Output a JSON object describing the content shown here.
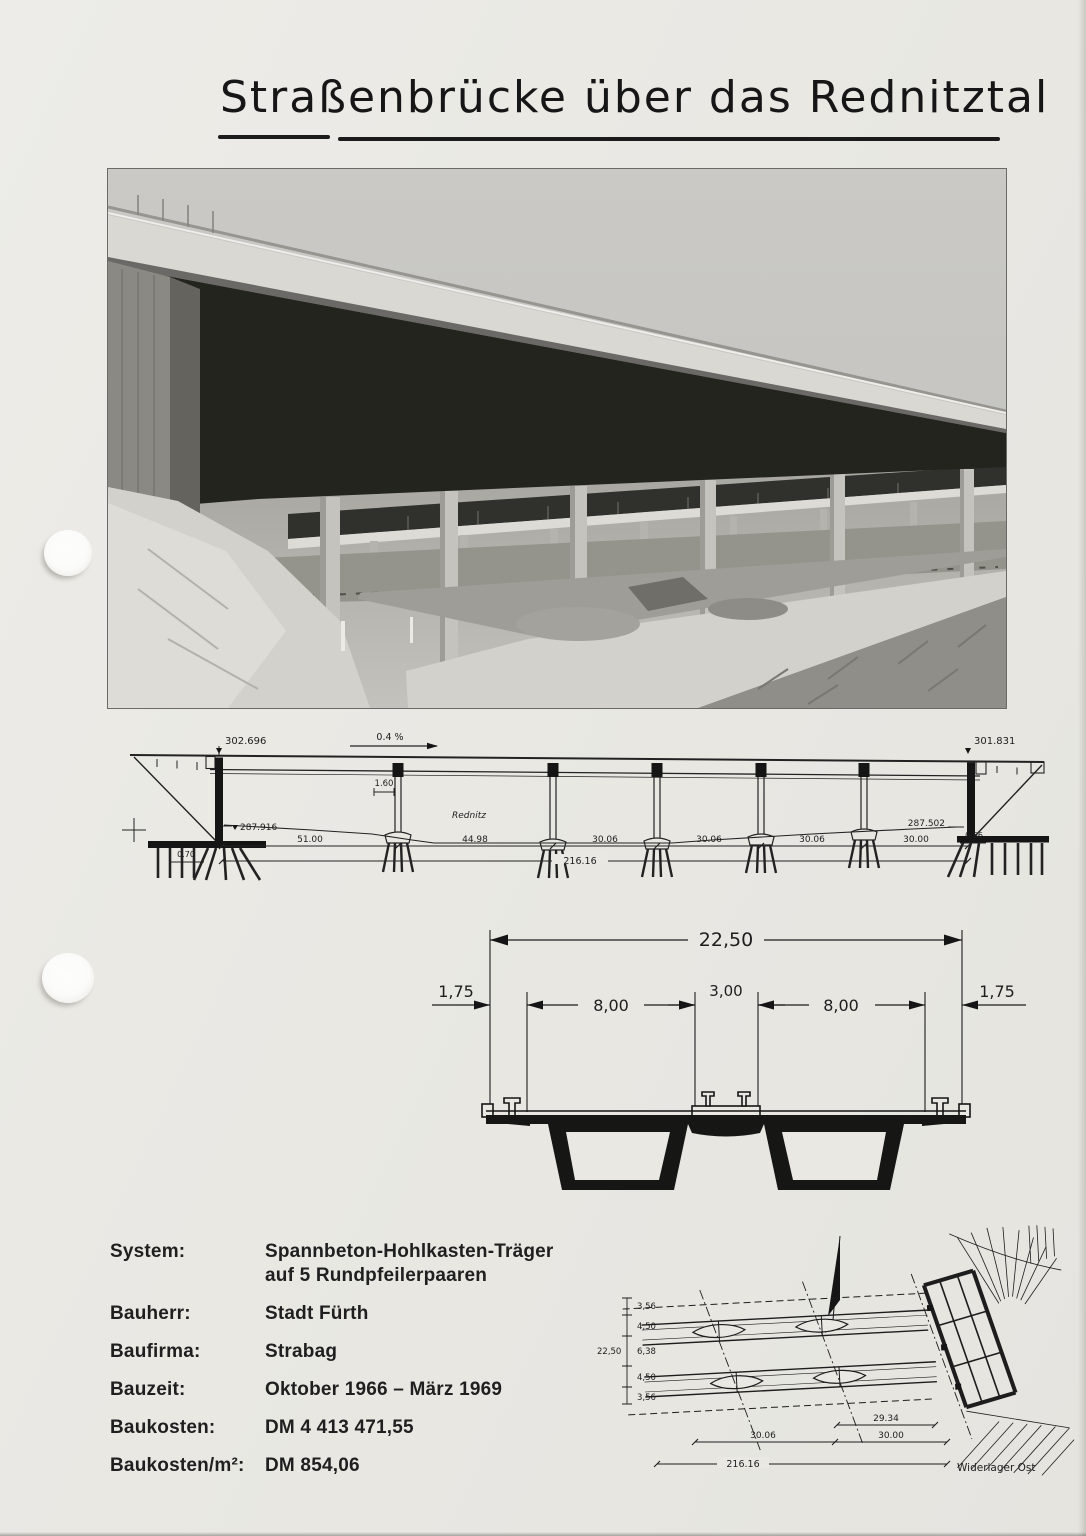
{
  "title": {
    "text": "Straßenbrücke über das Rednitztal"
  },
  "elevation": {
    "level_left_top": "302.696",
    "slope": "0.4 %",
    "river": "Rednitz",
    "pier_width": "1.60",
    "level_left_base": "287.916",
    "level_right_top": "301.831",
    "level_right_base": "287.502",
    "offset_left": "0.70",
    "offset_right": "0.66",
    "spans": [
      "51.00",
      "44.98",
      "30.06",
      "30.06",
      "30.06",
      "30.00"
    ],
    "total_length": "216.16"
  },
  "cross_section": {
    "total": "22,50",
    "parts": [
      "1,75",
      "8,00",
      "3,00",
      "8,00",
      "1,75"
    ]
  },
  "info": {
    "rows": [
      {
        "label": "System:",
        "value": "Spannbeton-Hohlkasten-Träger",
        "value2": "auf 5 Rundpfeilerpaaren"
      },
      {
        "label": "Bauherr:",
        "value": "Stadt Fürth"
      },
      {
        "label": "Baufirma:",
        "value": "Strabag"
      },
      {
        "label": "Bauzeit:",
        "value": "Oktober 1966 – März 1969"
      },
      {
        "label": "Baukosten:",
        "value": "DM  4 413 471,55"
      },
      {
        "label": "Baukosten/m²:",
        "value": "DM  854,06"
      }
    ]
  },
  "plan": {
    "widths": [
      "3,56",
      "4,50",
      "6,38",
      "4,50",
      "3,56"
    ],
    "total_width": "22,50",
    "span_a": "30.06",
    "skew": "29.34",
    "span_b": "30.00",
    "total_length": "216.16",
    "abutment_label": "Widerlager Ost",
    "north_label": "N"
  }
}
